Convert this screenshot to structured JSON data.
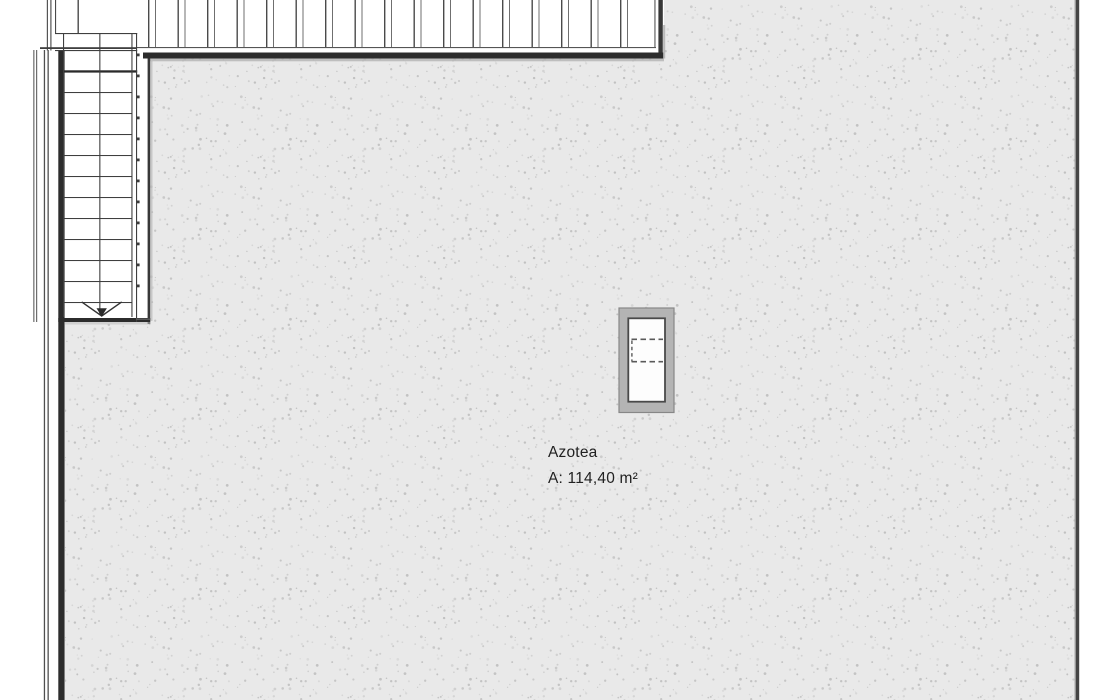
{
  "room": {
    "name": "Azotea",
    "area_label": "A: 114,40 m²"
  },
  "plan": {
    "stairs_arrow_direction": "down"
  },
  "colors": {
    "floor_fill": "#e9e9e9",
    "floor_dot": "#c9c9c9",
    "wall": "#2c2c2c",
    "line": "#3f3f3f",
    "pergola_line": "#4a4a4a",
    "pergola_line_light": "#6f6f6f",
    "hatch_frame": "#b4b4b4",
    "hatch_frame_border": "#878787",
    "hatch_inner_border": "#4a4a4a",
    "shadow": "#aaaaaa",
    "text": "#212121"
  }
}
